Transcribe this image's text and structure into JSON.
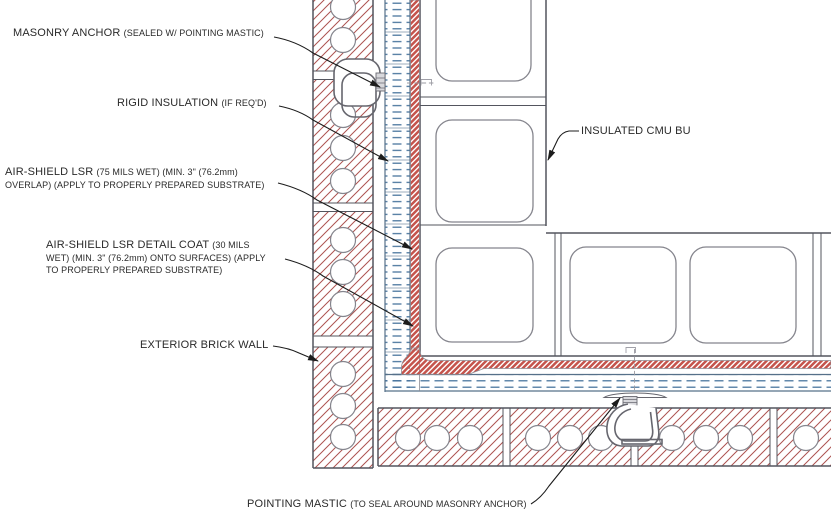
{
  "colors": {
    "brick_hatch_red": "#ad5350",
    "membrane_red": "#c5544c",
    "insulation_blue": "#44719b",
    "outline_dark": "#53555e",
    "cmu_cell_gray": "#85858d",
    "anchor_wire_gray": "#66666e",
    "leader_black": "#1c1c1c",
    "label_text": "#2a2a2a"
  },
  "labels": {
    "masonry_anchor": {
      "main": "MASONRY ANCHOR",
      "detail": "(SEALED W/ POINTING MASTIC)"
    },
    "rigid_insulation": {
      "main": "RIGID INSULATION",
      "detail": "(IF REQ'D)"
    },
    "air_shield_lsr": {
      "main": "AIR-SHIELD LSR",
      "detail1": "(75 MILS WET) (MIN. 3\" (76.2mm)",
      "detail2": "OVERLAP) (APPLY TO PROPERLY PREPARED SUBSTRATE)"
    },
    "air_shield_detail_coat": {
      "main": "AIR-SHIELD LSR DETAIL COAT",
      "detail1": "(30 MILS",
      "detail2": "WET) (MIN. 3\" (76.2mm) ONTO SURFACES) (APPLY",
      "detail3": "TO PROPERLY PREPARED SUBSTRATE)"
    },
    "exterior_brick_wall": {
      "main": "EXTERIOR BRICK WALL"
    },
    "insulated_cmu": {
      "main": "INSULATED CMU BU"
    },
    "pointing_mastic": {
      "main": "POINTING MASTIC",
      "detail": "(TO SEAL AROUND MASONRY ANCHOR)"
    }
  }
}
